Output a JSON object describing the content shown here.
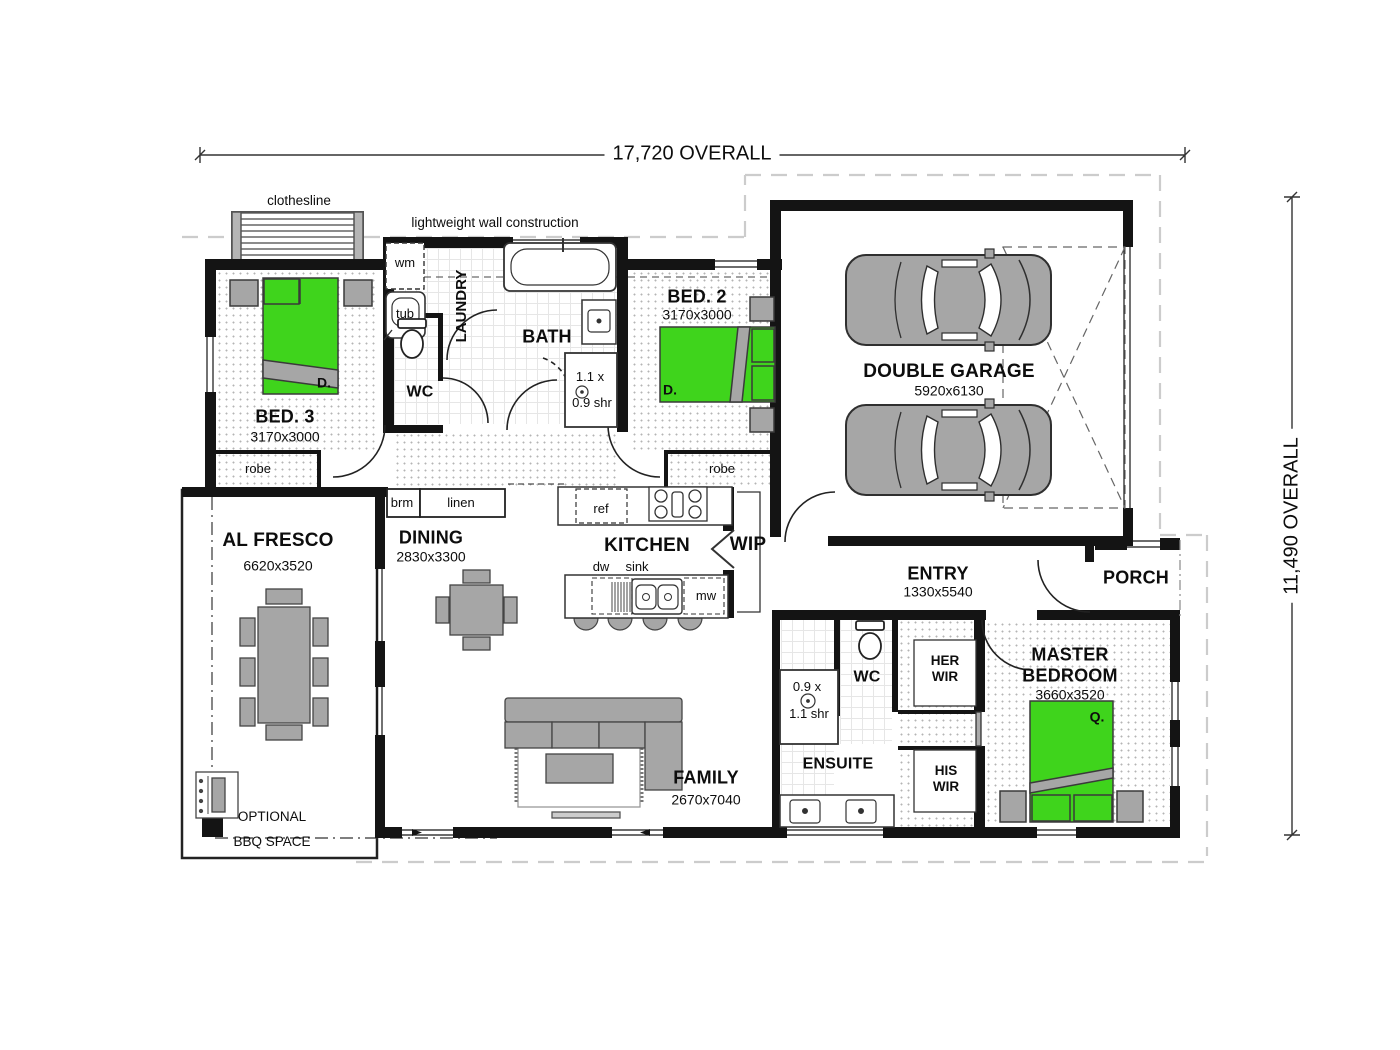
{
  "labels": {
    "dim_top": "17,720 OVERALL",
    "dim_right": "11,490 OVERALL",
    "clothesline": "clothesline",
    "lightweight_wall": "lightweight wall construction",
    "optional1": "OPTIONAL",
    "optional2": "BBQ SPACE"
  },
  "rooms": {
    "bed3": {
      "name": "BED. 3",
      "dims": "3170x3000",
      "bed_tag": "D.",
      "robe": "robe"
    },
    "bed2": {
      "name": "BED. 2",
      "dims": "3170x3000",
      "bed_tag": "D.",
      "robe": "robe"
    },
    "laundry": {
      "name": "LAUNDRY"
    },
    "wc": {
      "name": "WC"
    },
    "bath": {
      "name": "BATH",
      "shr1": "1.1 x",
      "shr2": "0.9 shr"
    },
    "garage": {
      "name": "DOUBLE GARAGE",
      "dims": "5920x6130"
    },
    "alfresco": {
      "name": "AL FRESCO",
      "dims": "6620x3520"
    },
    "dining": {
      "name": "DINING",
      "dims": "2830x3300"
    },
    "kitchen": {
      "name": "KITCHEN"
    },
    "wip": {
      "name": "WIP"
    },
    "entry": {
      "name": "ENTRY",
      "dims": "1330x5540"
    },
    "porch": {
      "name": "PORCH"
    },
    "family": {
      "name": "FAMILY",
      "dims": "2670x7040"
    },
    "ensuite": {
      "name": "ENSUITE",
      "wc": "WC",
      "shr1": "0.9 x",
      "shr2": "1.1 shr"
    },
    "her_wir": {
      "l1": "HER",
      "l2": "WIR"
    },
    "his_wir": {
      "l1": "HIS",
      "l2": "WIR"
    },
    "master": {
      "l1": "MASTER",
      "l2": "BEDROOM",
      "dims": "3660x3520",
      "bed_tag": "Q."
    }
  },
  "fixtures": {
    "wm": "wm",
    "tub": "tub",
    "brm": "brm",
    "linen": "linen",
    "ref": "ref",
    "dw": "dw",
    "sink": "sink",
    "mw": "mw"
  },
  "colors": {
    "bed_green": "#3fd41c",
    "furniture_gray": "#a6a6a6",
    "wall_black": "#141414"
  }
}
